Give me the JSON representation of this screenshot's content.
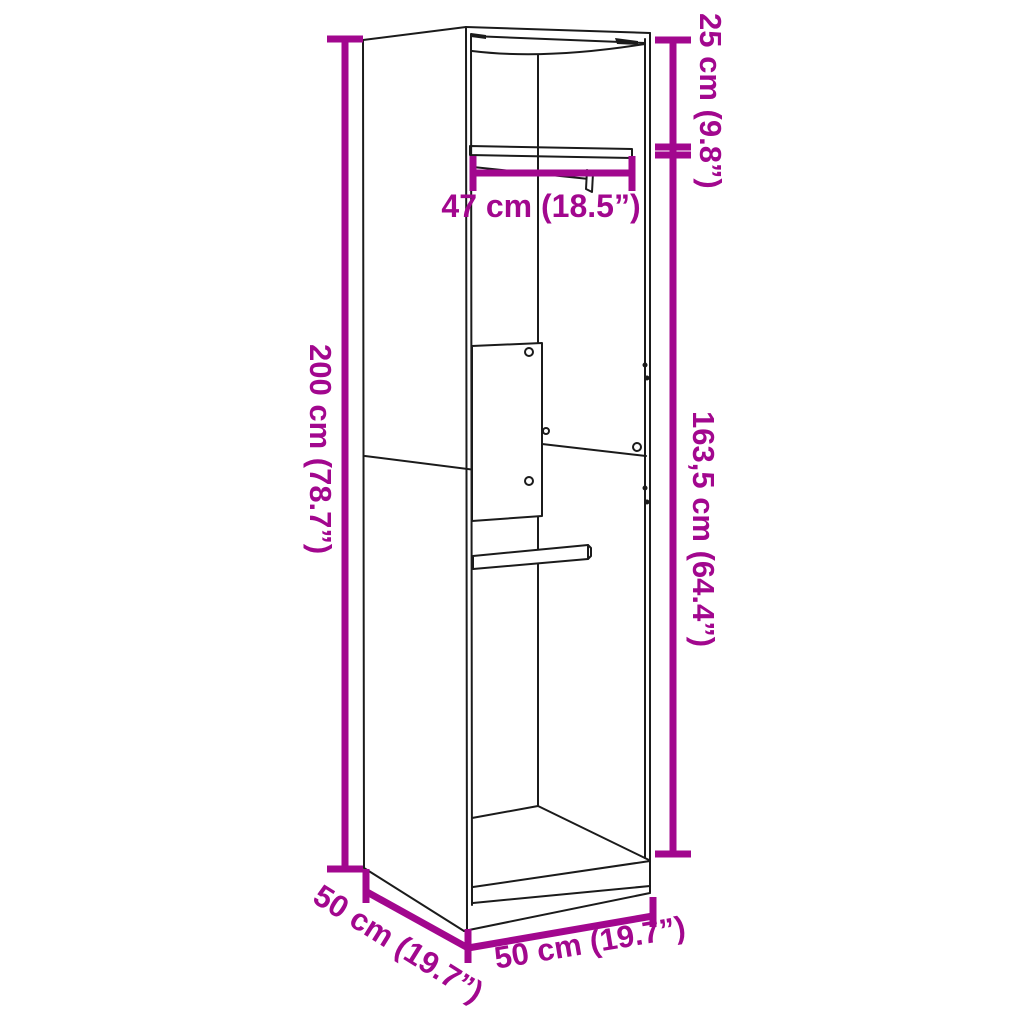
{
  "diagram_title": "wardrobe-dimension-diagram",
  "colors": {
    "dimension_accent": "#A2078E",
    "line_art": "#1b1b1b",
    "background": "#ffffff"
  },
  "dimensions": {
    "total_height": {
      "label": "200 cm (78.7”)"
    },
    "top_compartment_height": {
      "label": "25 cm (9.8”)"
    },
    "hanging_space_height": {
      "label": "163,5 cm (64.4”)"
    },
    "inner_shelf_width": {
      "label": "47 cm (18.5”)"
    },
    "depth": {
      "label": "50 cm (19.7”)"
    },
    "width": {
      "label": "50 cm (19.7”)"
    }
  }
}
